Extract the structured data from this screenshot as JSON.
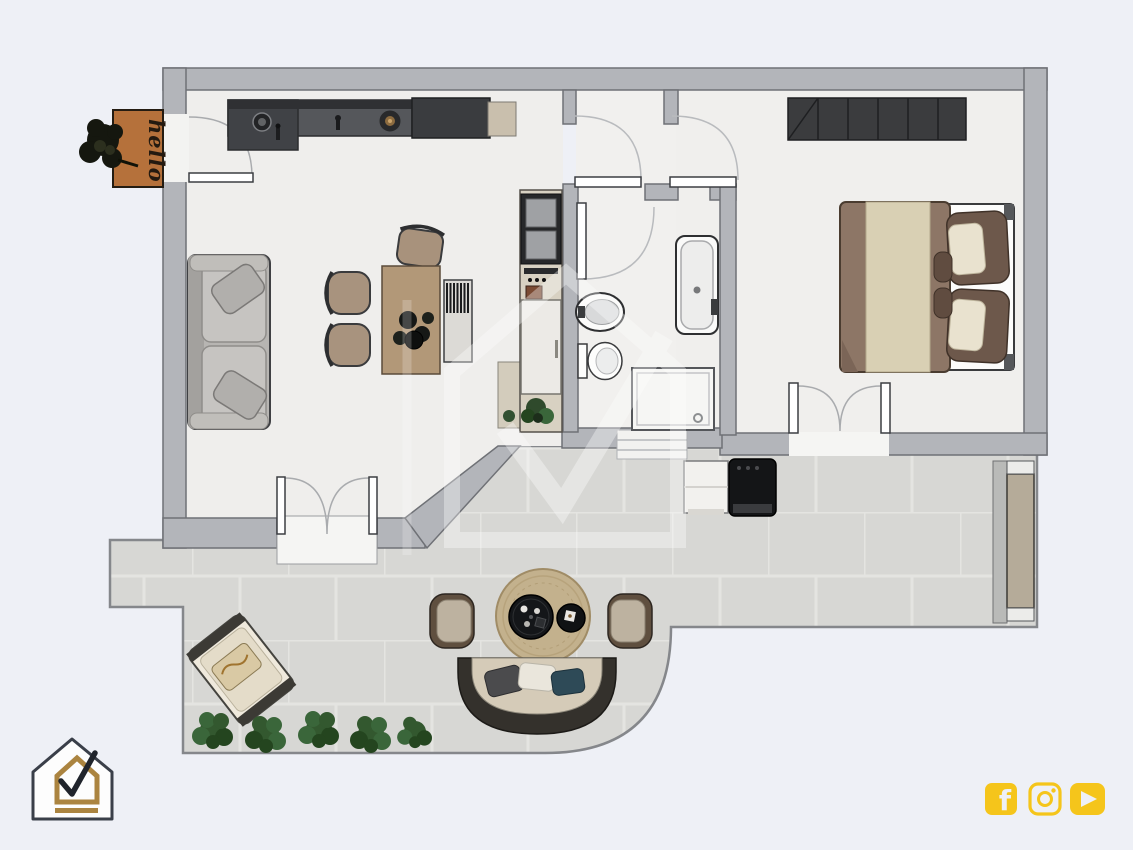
{
  "doormat": {
    "text": "hello"
  },
  "branding": {
    "logo": "house-check-logo",
    "watermark": "house-check-watermark"
  },
  "social": {
    "icons": [
      "facebook",
      "instagram",
      "youtube"
    ]
  },
  "floorplan": {
    "items": [
      "kitchen-counter",
      "kitchen-island",
      "sofa",
      "dining-table",
      "dining-chairs",
      "desk-chair",
      "radiator",
      "tall-cabinet-column",
      "washbasin",
      "toilet",
      "bathtub",
      "shower",
      "double-bed",
      "stairs",
      "entrance-door",
      "interior-doors",
      "french-doors",
      "terrace",
      "lounge-chair",
      "outdoor-armchairs",
      "outdoor-sofa",
      "round-rug",
      "coffee-table",
      "side-table",
      "bushes",
      "grill",
      "outdoor-cabinet",
      "planter",
      "doormat-plant"
    ]
  },
  "colors": {
    "background": "#eef0f6",
    "wall": "#b3b5ba",
    "wall_outline": "#6f7176",
    "floor": "#efeeec",
    "tile": "#d7d7d4",
    "social_yellow": "#f5c51b",
    "logo_gold": "#ab8440",
    "doormat": "#b5713b",
    "plant": "#33582f",
    "stairs": "#3b3c3e",
    "wood": "#b29878",
    "sofa": "#b7b5b2",
    "bed_blanket": "#8d7666",
    "bed_runner": "#d9d0b4"
  }
}
